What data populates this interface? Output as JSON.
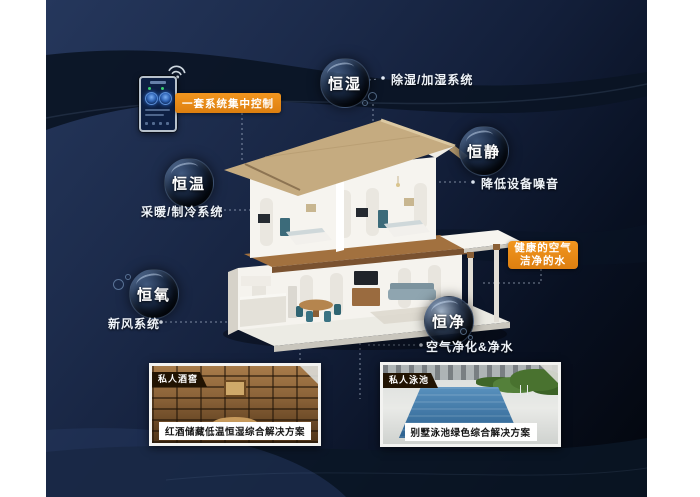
{
  "colors": {
    "accent_orange": "#e8891b",
    "background_navy": "#1c2b4b",
    "background_dark": "#03060c",
    "panel_border": "#f3f3f1",
    "bubble_text": "#ffffff",
    "pool_water": "#2c618f",
    "cellar_wood": "#8a6238"
  },
  "control_badge": {
    "label": "一套系统集中控制"
  },
  "healthy_badge": {
    "line1": "健康的空气",
    "line2": "洁净的水"
  },
  "bubbles": {
    "humidity": {
      "label": "恒湿"
    },
    "quiet": {
      "label": "恒静"
    },
    "temperature": {
      "label": "恒温"
    },
    "oxygen": {
      "label": "恒氧"
    },
    "clean": {
      "label": "恒净"
    }
  },
  "system_labels": {
    "dehumidify": "除湿/加湿系统",
    "noise": "降低设备噪音",
    "hvac": "采暖/制冷系统",
    "fresh_air": "新风系统",
    "purify": "空气净化&净水"
  },
  "panels": {
    "wine_cellar": {
      "tag": "私人酒窖",
      "caption": "红酒储藏低温恒湿综合解决方案"
    },
    "pool": {
      "tag": "私人泳池",
      "caption": "别墅泳池绿色综合解决方案"
    }
  }
}
